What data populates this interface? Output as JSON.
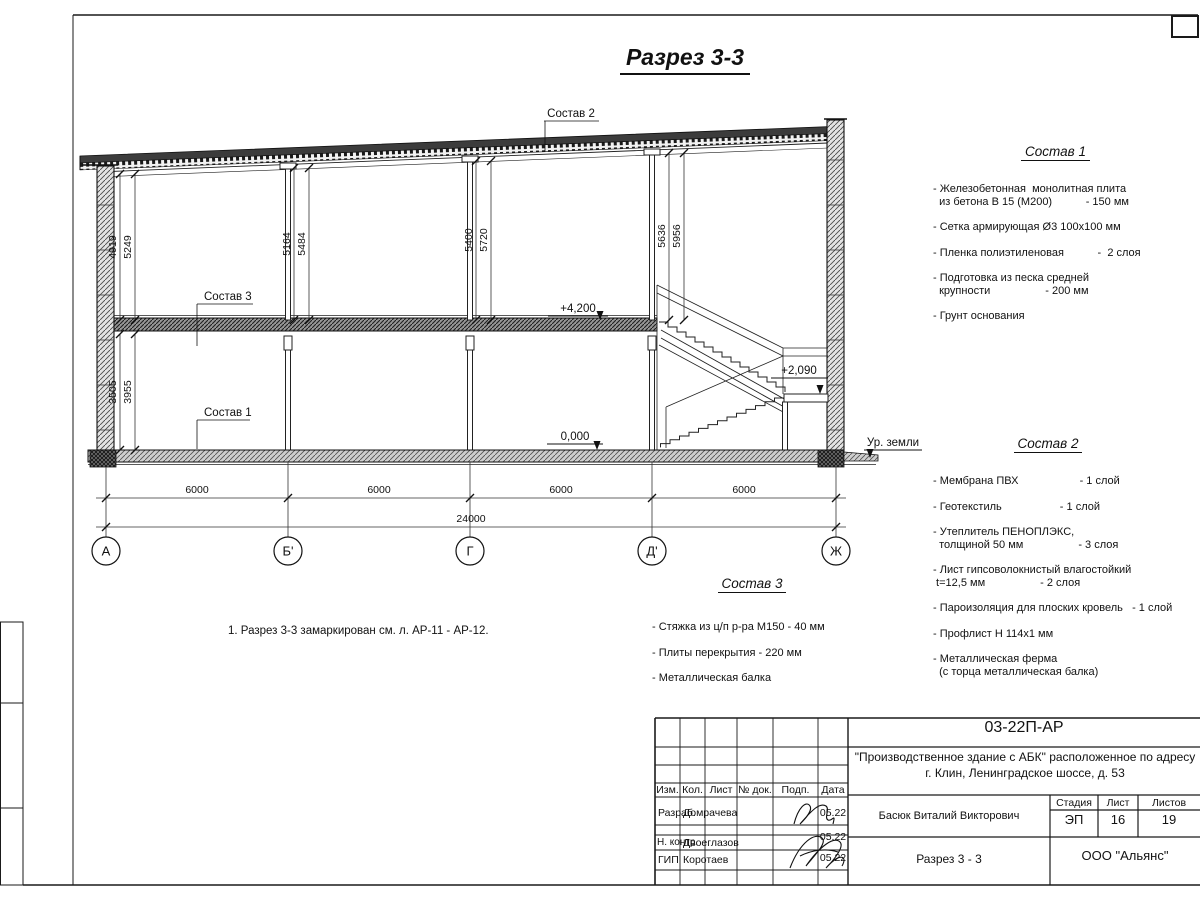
{
  "title": "Разрез 3-3",
  "note": "1. Разрез 3-3 замаркирован см. л. АР-11 - АР-12.",
  "drawing": {
    "axis_labels": [
      "А",
      "Б'",
      "Г",
      "Д'",
      "Ж"
    ],
    "dims_bottom": [
      "6000",
      "6000",
      "6000",
      "6000"
    ],
    "dim_total": "24000",
    "vdims": [
      "4919",
      "5249",
      "3505",
      "3955",
      "5164",
      "5484",
      "5400",
      "5720",
      "5636",
      "5956"
    ],
    "levels": {
      "floor2": "+4,200",
      "floor1": "0,000",
      "landing": "+2,090",
      "ground": "Ур. земли"
    },
    "callouts": {
      "c1": "Состав 1",
      "c2": "Состав 2",
      "c3": "Состав 3"
    }
  },
  "legends": {
    "l1": {
      "title": "Состав 1",
      "items": [
        "- Железобетонная  монолитная плита\n  из бетона В 15 (М200)           - 150 мм",
        "- Сетка армирующая Ø3 100х100 мм",
        "- Пленка полиэтиленовая           -  2 слоя",
        "- Подготовка из песка средней\n  крупности                  - 200 мм",
        "- Грунт основания"
      ]
    },
    "l2": {
      "title": "Состав 2",
      "items": [
        "- Мембрана ПВХ                    - 1 слой",
        "- Геотекстиль                   - 1 слой",
        "- Утеплитель ПЕНОПЛЭКС,\n  толщиной 50 мм                  - 3 слоя",
        "- Лист гипсоволокнистый влагостойкий\n t=12,5 мм                  - 2 слоя",
        "- Пароизоляция для плоских кровель   - 1 слой",
        "- Профлист Н 114х1 мм",
        "- Металлическая ферма\n  (с торца металлическая балка)"
      ]
    },
    "l3": {
      "title": "Состав 3",
      "items": [
        "- Стяжка из ц/п р-ра М150 - 40 мм",
        "- Плиты перекрытия - 220 мм",
        "- Металлическая балка"
      ]
    }
  },
  "titleblock": {
    "doc_number": "03-22П-АР",
    "project_line1": "\"Производственное здание с АБК\" расположенное по адресу",
    "project_line2": "г. Клин, Ленинградское шоссе, д. 53",
    "columns": [
      "Изм.",
      "Кол.",
      "Лист",
      "№ док.",
      "Подп.",
      "Дата"
    ],
    "rows": [
      {
        "role": "Разраб.",
        "name": "Домрачева",
        "date": "05.22"
      },
      {
        "role": "Н. контр.",
        "name": "Двоеглазов",
        "date": "05.22"
      },
      {
        "role": "ГИП",
        "name": "Коротаев",
        "date": "05.22"
      }
    ],
    "approver": "Басюк Виталий Викторович",
    "stage_label": "Стадия",
    "sheet_label": "Лист",
    "sheets_label": "Листов",
    "stage": "ЭП",
    "sheet": "16",
    "sheets": "19",
    "drawing_title": "Разрез 3 - 3",
    "company": "ООО \"Альянс\""
  }
}
